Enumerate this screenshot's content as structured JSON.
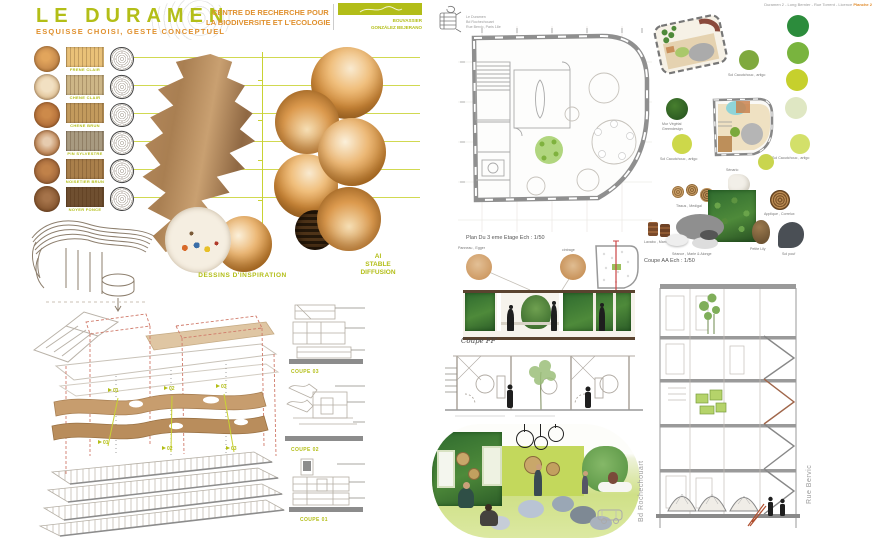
{
  "theme": {
    "accent_green": "#b3be17",
    "accent_orange": "#e0912f",
    "line_green": "#c9d233",
    "wood_planks": [
      "#e9c178",
      "#cdb687",
      "#c29a5d",
      "#a89a80",
      "#a97f4b",
      "#6f4f30"
    ]
  },
  "left": {
    "header": {
      "title": "LE DURAMEN",
      "subtitle": "ESQUISSE CHOISI, GESTE CONCEPTUEL",
      "org_line1": "CENTRE DE RECHERCHE POUR",
      "org_line2": "LA BIODIVERSITE ET L'ECOLOGIE",
      "author1": "BOUVASSIER",
      "author2": "GONZÁLEZ BEJERANO"
    },
    "materials": {
      "items": [
        {
          "label": "FRENE CLAIR"
        },
        {
          "label": "CHENE CLAIR"
        },
        {
          "label": "CHENE BRUN"
        },
        {
          "label": "PIN SYLVESTRE"
        },
        {
          "label": "NOISETIER BRUN"
        },
        {
          "label": "NOYER FONCE"
        }
      ]
    },
    "inspiration_label": "DESSINS D'INSPIRATION",
    "ai_label": {
      "line1": "AI",
      "line2": "STABLE",
      "line3": "DIFFUSION"
    },
    "axon": {
      "markers": [
        "01",
        "02",
        "03"
      ]
    },
    "coupes": [
      "COUPE 03",
      "COUPE 02",
      "COUPE 01"
    ]
  },
  "right": {
    "header": {
      "note": "Duramen 2 - Long Bernier - Rue Torrent - Licence",
      "planche": "Planche 2"
    },
    "logo": {
      "line1": "Le Duramen",
      "line2": "Bd Rochechouart",
      "line3": "Rue Bervic, Paris 18e"
    },
    "plan_caption": "Plan Du 3 eme Etage   Ech : 1/50",
    "samples": {
      "sample1": "Panneau , Egger",
      "sample2": "cintrage"
    },
    "labels": {
      "sol_artigo": "Sol Caoutchouc , artigo",
      "mur_vegetal_1": "Mur Végétal",
      "mur_vegetal_2": "Greendesign",
      "senario": "Sénario",
      "tissus": "Tissus , Medigal",
      "applique": "Applique , Correlux",
      "lavabo": "Lavabo , Marmoring",
      "seance": "Séance , Marle & Alonge",
      "petite_lily": "Petite Lily",
      "sol_pouf": "Sol pouf"
    },
    "coupe_aa": "Coupe AA   Ech : 1/50",
    "coupe_ff": "Coupe FF'",
    "streets": {
      "left": "Bd Rochechouart",
      "right": "Rue Bervic"
    },
    "palette": [
      "#2c8c3c",
      "#79b43e",
      "#c6d02d",
      "#dfe7c3"
    ]
  }
}
